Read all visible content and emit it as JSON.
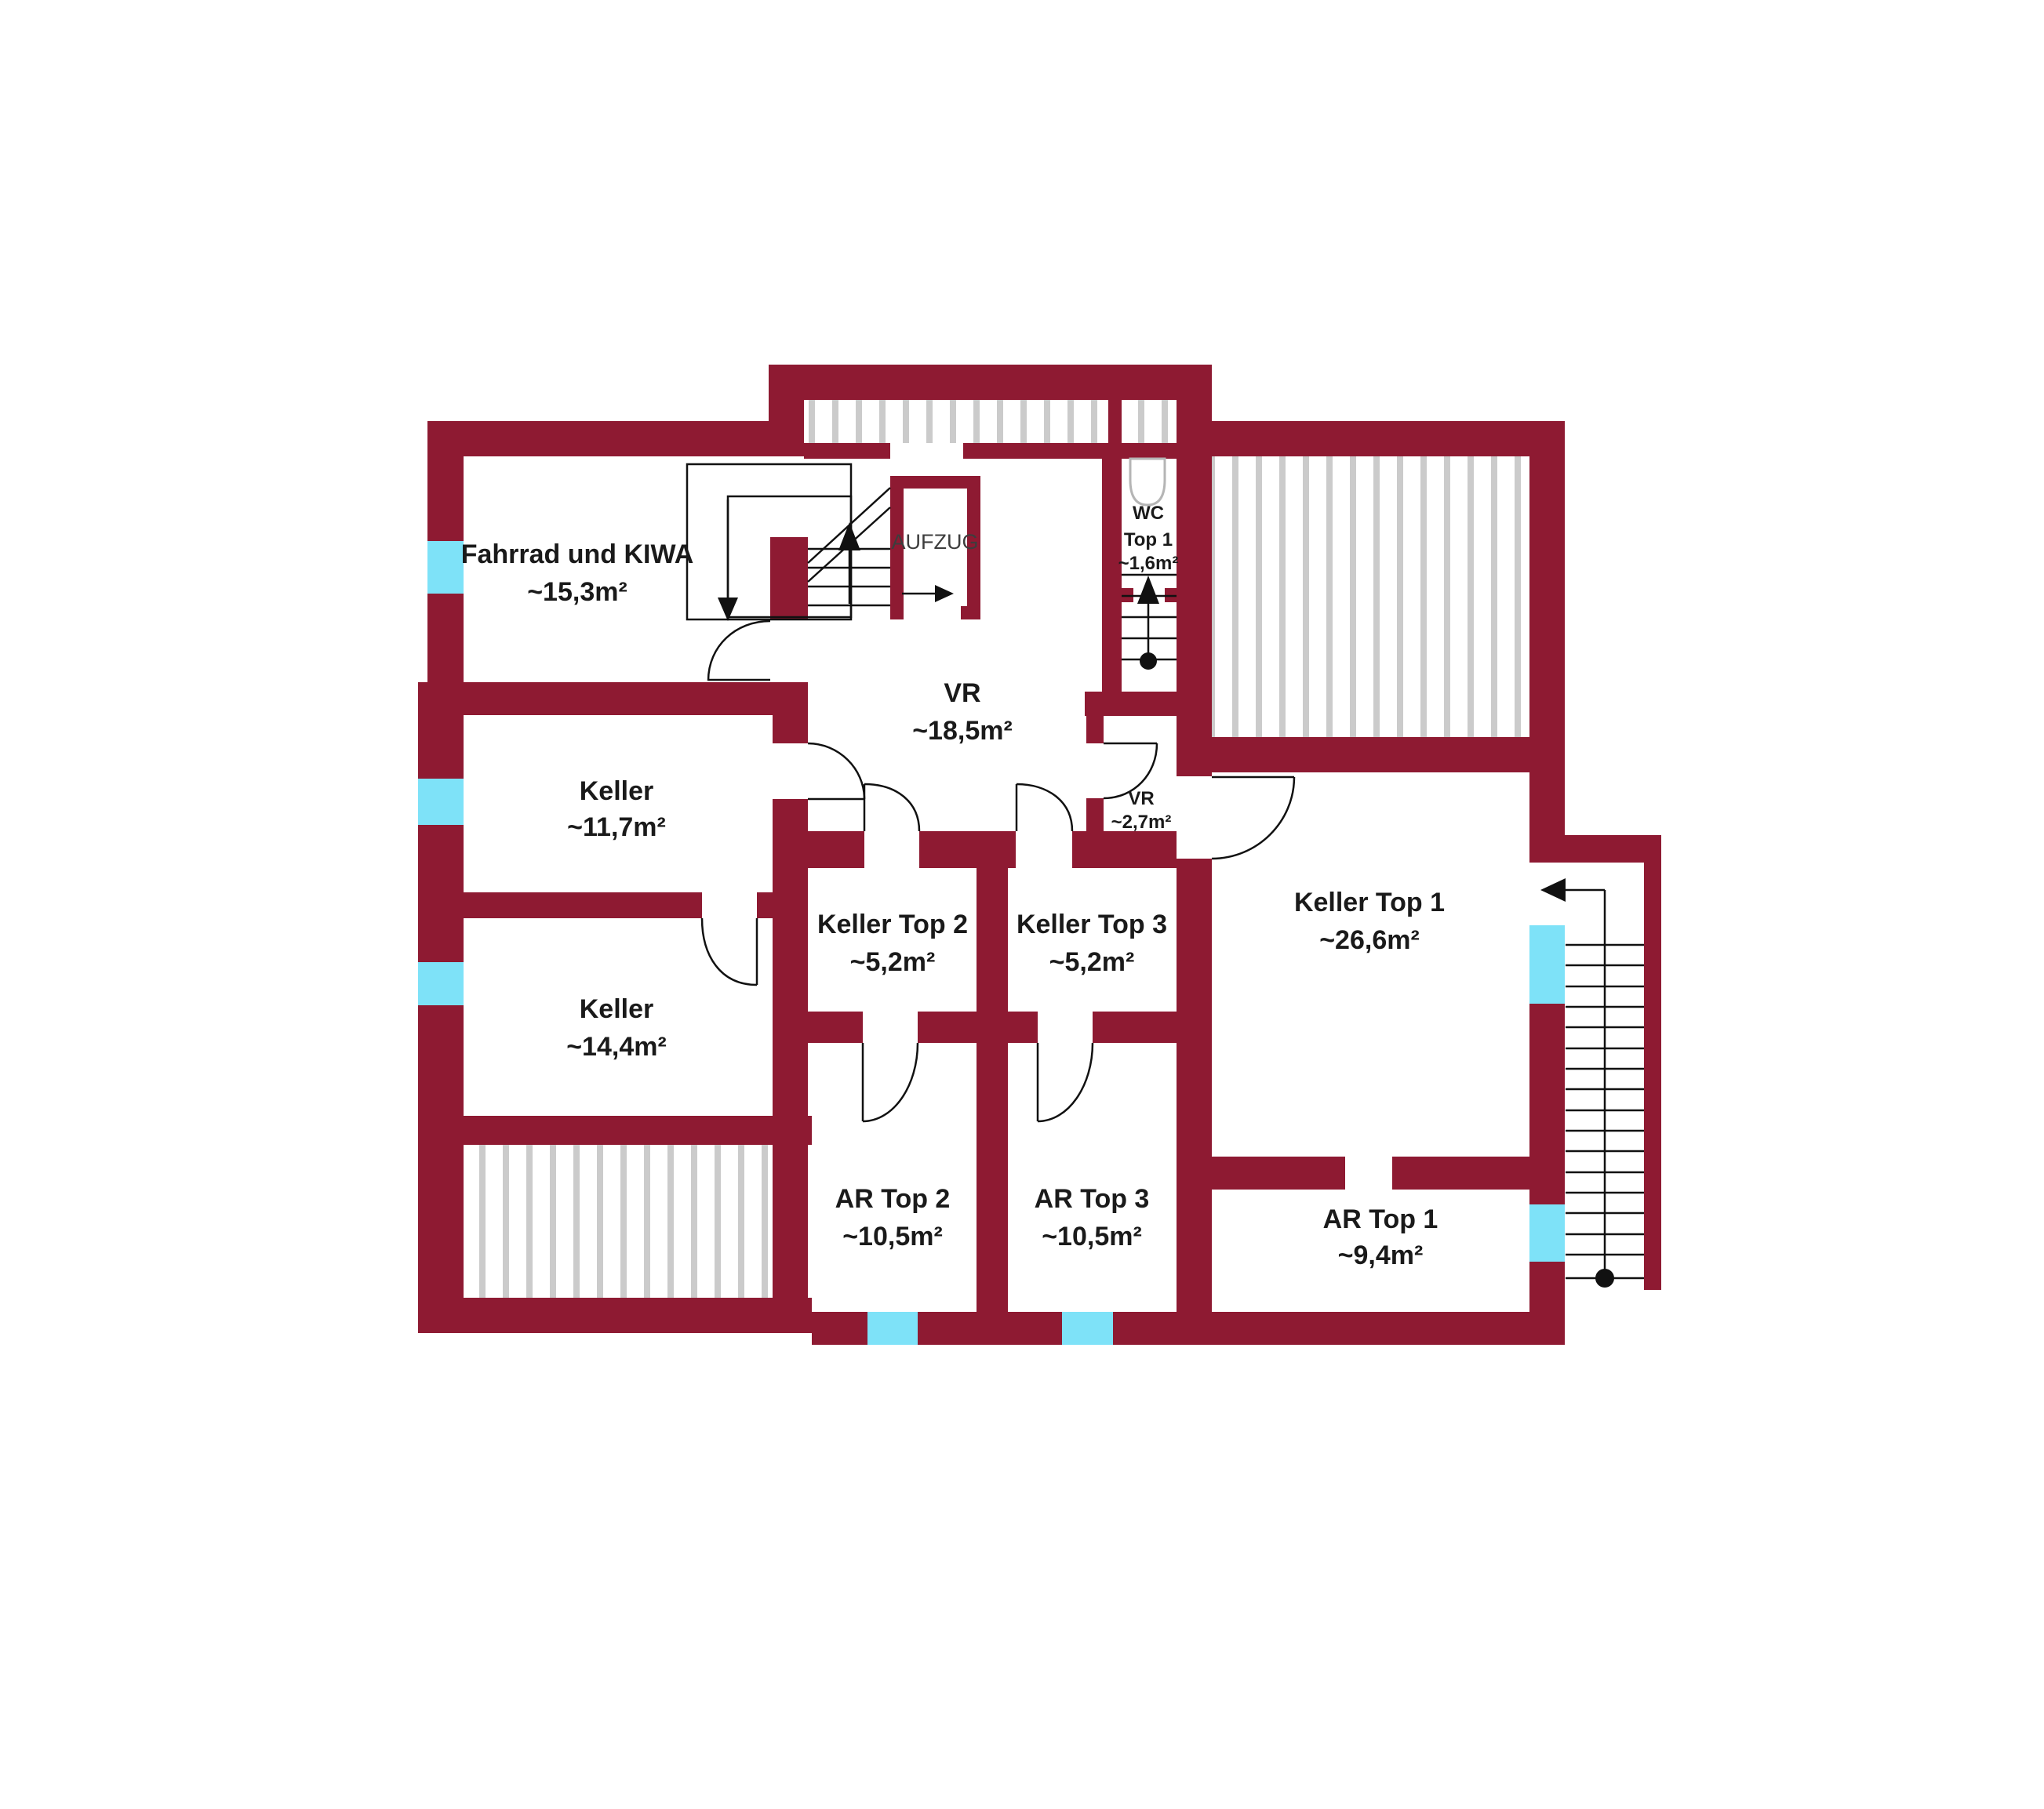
{
  "plan": {
    "type": "basement-floorplan",
    "colors": {
      "wall": "#8E1A32",
      "window": "#7EE2F8",
      "hatch": "#CBCBCB",
      "line": "#111111",
      "text": "#1a1a1a"
    },
    "rooms": {
      "fahrrad": {
        "name": "Fahrrad und KIWA",
        "area": "~15,3m²"
      },
      "keller117": {
        "name": "Keller",
        "area": "~11,7m²"
      },
      "keller144": {
        "name": "Keller",
        "area": "~14,4m²"
      },
      "vr": {
        "name": "VR",
        "area": "~18,5m²"
      },
      "wc_top1": {
        "name": "WC",
        "line2": "Top 1",
        "area": "~1,6m²"
      },
      "vr_top1": {
        "name": "VR",
        "area": "~2,7m²"
      },
      "keller_top2": {
        "name": "Keller Top 2",
        "area": "~5,2m²"
      },
      "keller_top3": {
        "name": "Keller Top 3",
        "area": "~5,2m²"
      },
      "keller_top1": {
        "name": "Keller Top 1",
        "area": "~26,6m²"
      },
      "ar_top2": {
        "name": "AR Top 2",
        "area": "~10,5m²"
      },
      "ar_top3": {
        "name": "AR Top 3",
        "area": "~10,5m²"
      },
      "ar_top1": {
        "name": "AR Top 1",
        "area": "~9,4m²"
      }
    },
    "labels": {
      "elevator": "AUFZUG"
    }
  }
}
